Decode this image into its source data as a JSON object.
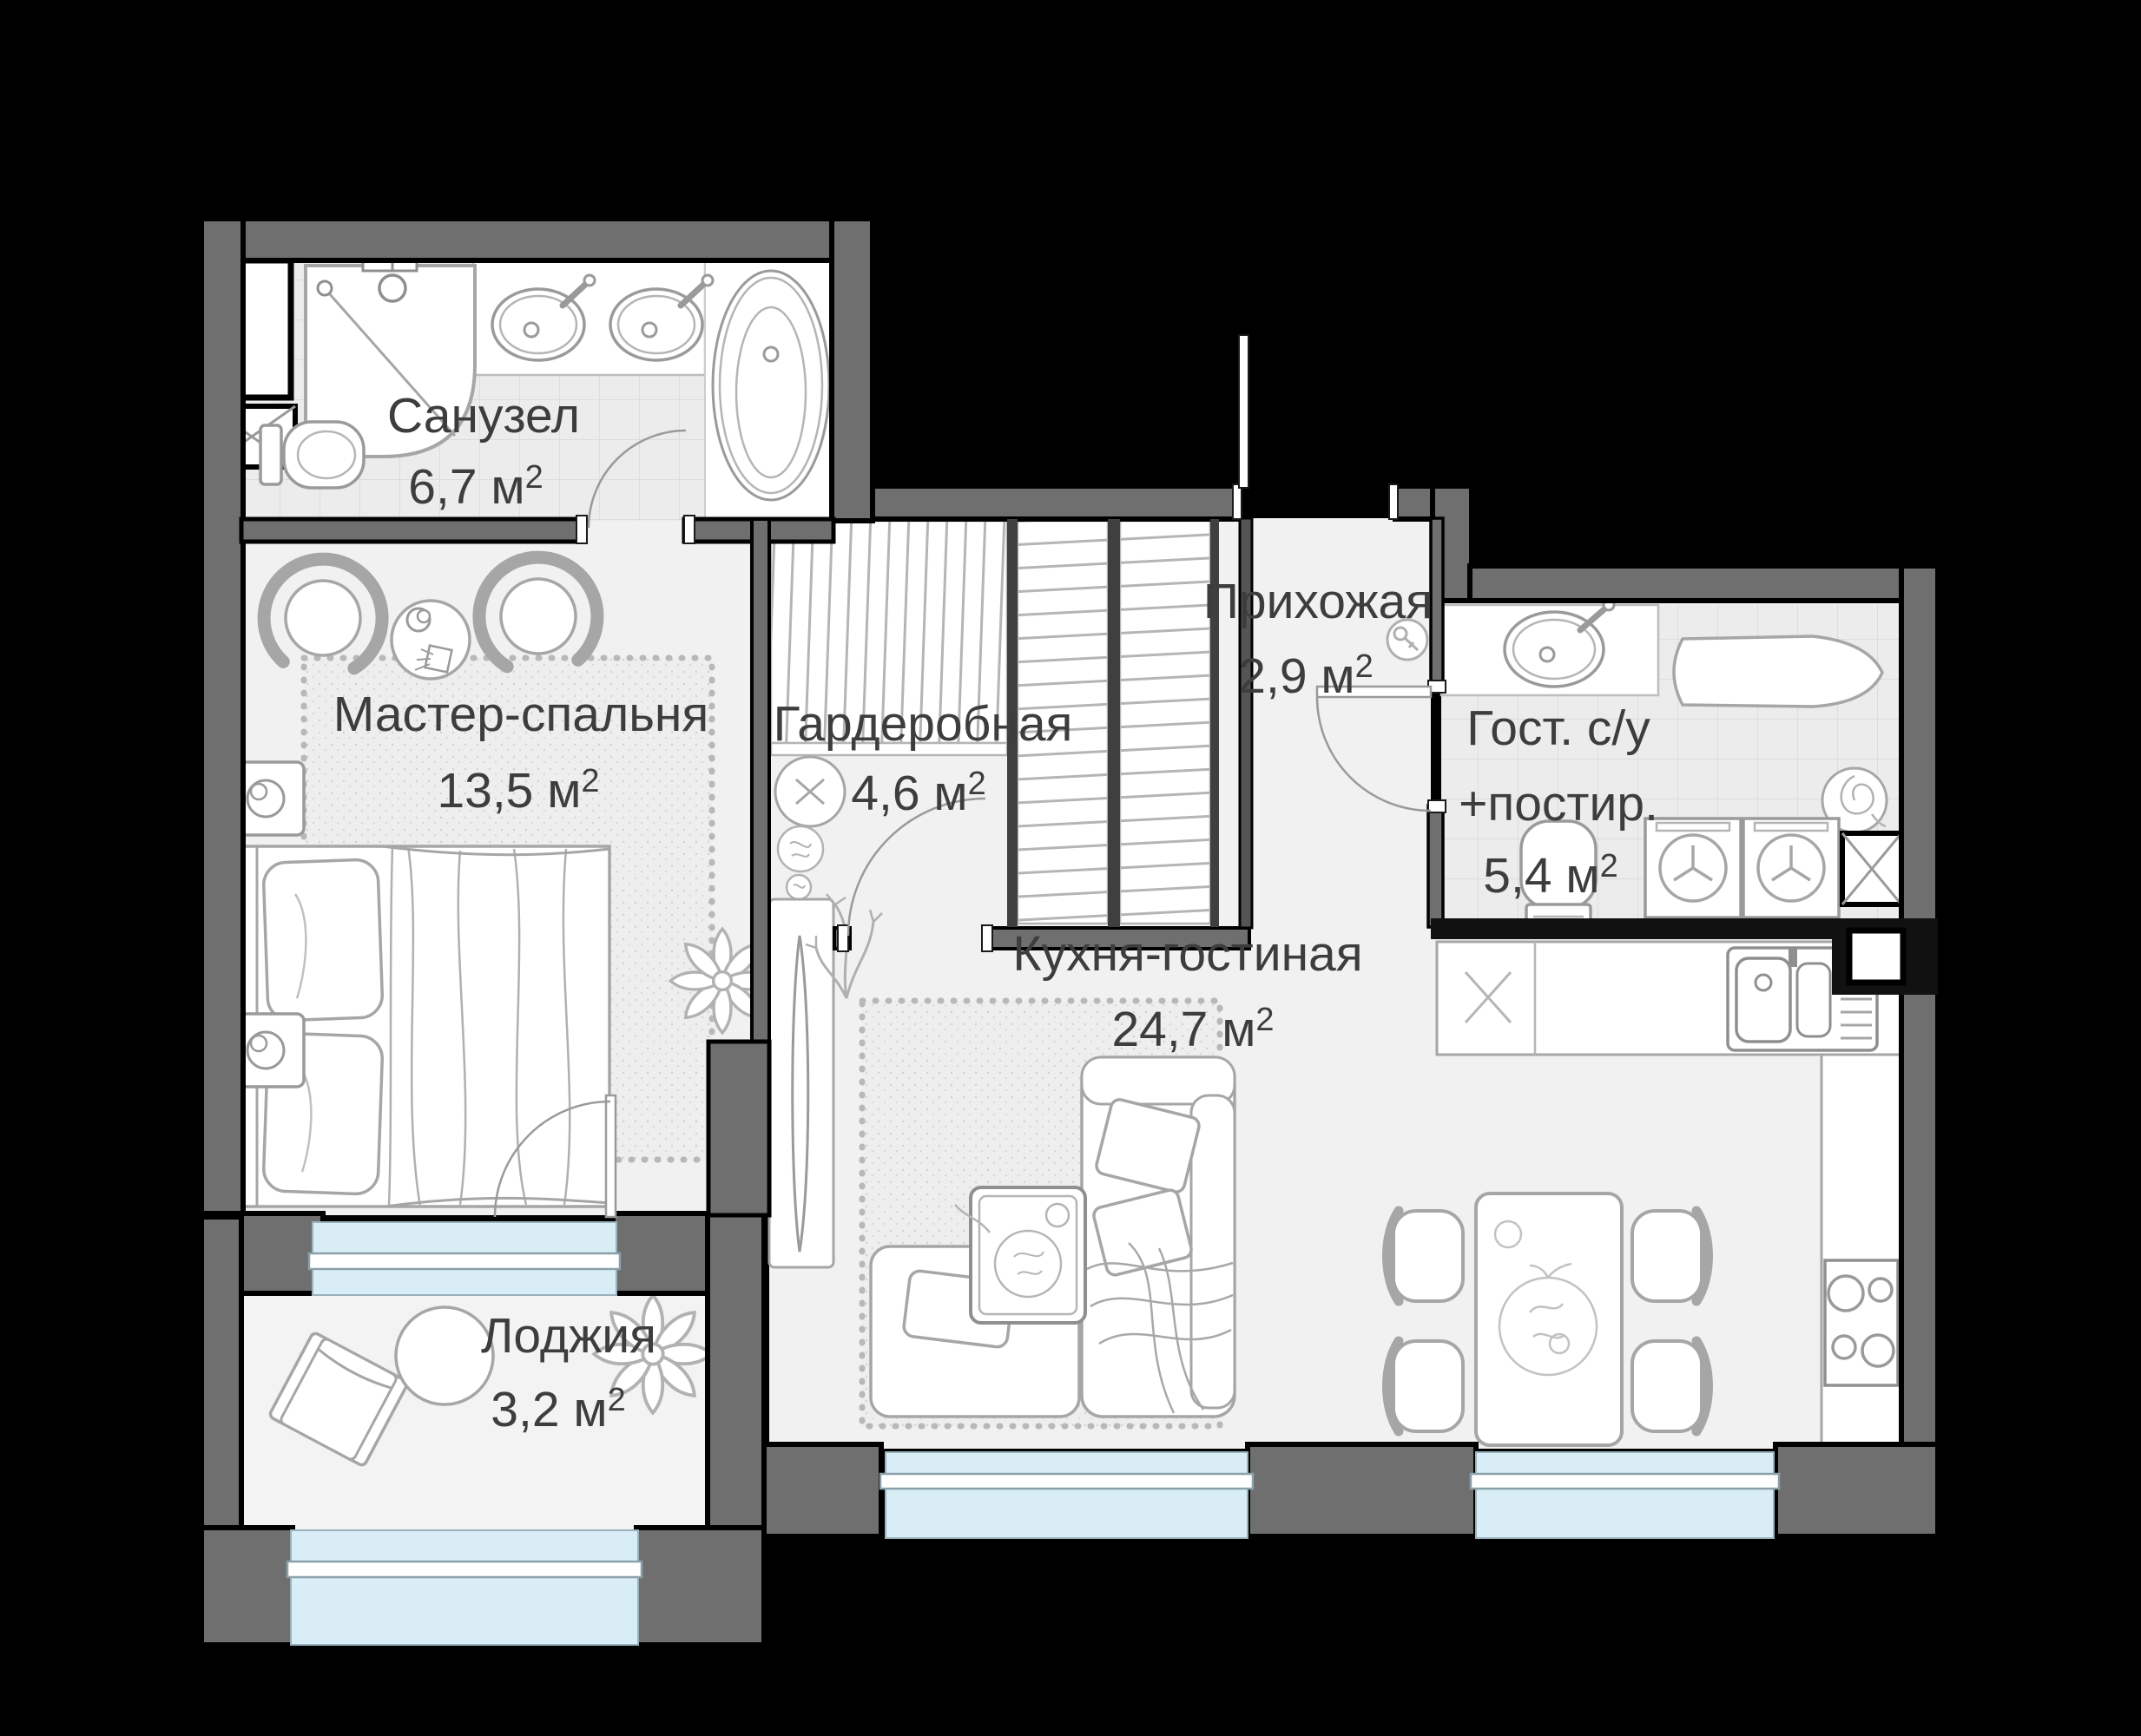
{
  "meta": {
    "background": "#000000",
    "wall_color": "#6f6f6f",
    "floor_color": "#f1f1f1",
    "tile_color": "#ececec",
    "window_color": "#d9edf6",
    "text_color": "#3d3d3d",
    "furniture_line_color": "#a6a6a6"
  },
  "labels": {
    "area_sup": "2"
  },
  "rooms": [
    {
      "id": "bathroom",
      "name": "Санузел",
      "area": "6,7 м"
    },
    {
      "id": "master-bedroom",
      "name": "Мастер-спальня",
      "area": "13,5 м"
    },
    {
      "id": "wardrobe",
      "name": "Гардеробная",
      "area": "4,6 м"
    },
    {
      "id": "hallway",
      "name": "Прихожая",
      "area": "2,9 м"
    },
    {
      "id": "guest-bathroom",
      "name": "Гост. с/у",
      "name2": "+постир.",
      "area": "5,4 м"
    },
    {
      "id": "kitchen-living",
      "name": "Кухня-гостиная",
      "area": "24,7 м"
    },
    {
      "id": "loggia",
      "name": "Лоджия",
      "area": "3,2 м"
    }
  ]
}
